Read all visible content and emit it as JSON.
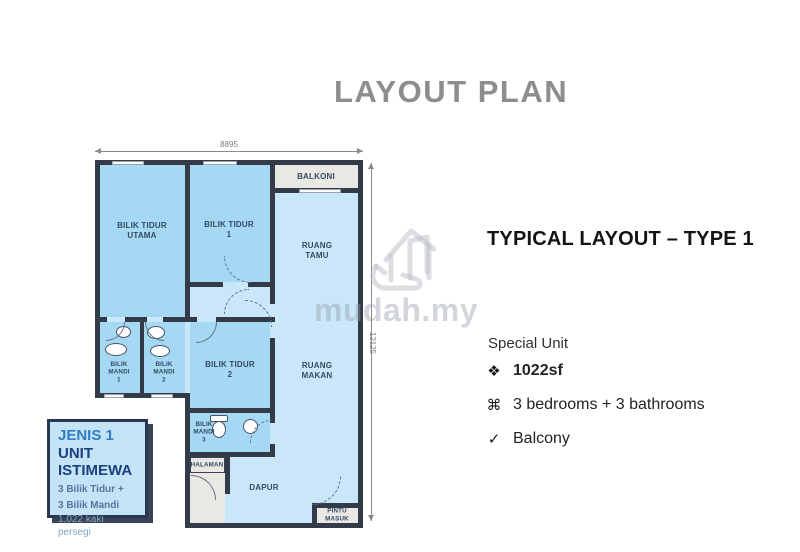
{
  "title": "LAYOUT PLAN",
  "plan": {
    "dim_width": "8895",
    "dim_height": "12125",
    "rooms": {
      "balkoni": [
        "BALKONI"
      ],
      "btu": [
        "BILIK TIDUR",
        "UTAMA"
      ],
      "bt1": [
        "BILIK TIDUR",
        "1"
      ],
      "tamu": [
        "RUANG",
        "TAMU"
      ],
      "bm1": [
        "BILIK",
        "MANDI",
        "1"
      ],
      "bm2": [
        "BILIK",
        "MANDI",
        "2"
      ],
      "bt2": [
        "BILIK TIDUR",
        "2"
      ],
      "makan": [
        "RUANG",
        "MAKAN"
      ],
      "bm3": [
        "BILIK",
        "MANDI",
        "3"
      ],
      "halaman": [
        "HALAMAN"
      ],
      "dapur": [
        "DAPUR"
      ],
      "pintu": [
        "PINTU",
        "MASUK"
      ]
    }
  },
  "info_box": {
    "lines": [
      "JENIS 1",
      "UNIT",
      "ISTIMEWA",
      "3 Bilik Tidur +",
      "3 Bilik Mandi",
      "1,022 kaki persegi"
    ]
  },
  "details": {
    "heading": "TYPICAL LAYOUT – TYPE 1",
    "subheading": "Special Unit",
    "items": [
      {
        "icon": "❖",
        "text": "1022sf"
      },
      {
        "icon": "⌘",
        "text": "3 bedrooms + 3 bathrooms"
      },
      {
        "icon": "✓",
        "text": "Balcony"
      }
    ]
  },
  "watermark": {
    "text": "mudah.my"
  },
  "colors": {
    "bedroom_fill": "#A5D8F2",
    "living_fill": "#C9E7F8",
    "outdoor_fill": "#EAE8E2",
    "wall": "#333B48",
    "title_gray": "#8D8D8D",
    "box_bg": "#C3E3F6",
    "box_border": "#2B3650",
    "box_blue_text": "#2E7FC1",
    "box_navy_text": "#1C3F7E"
  }
}
